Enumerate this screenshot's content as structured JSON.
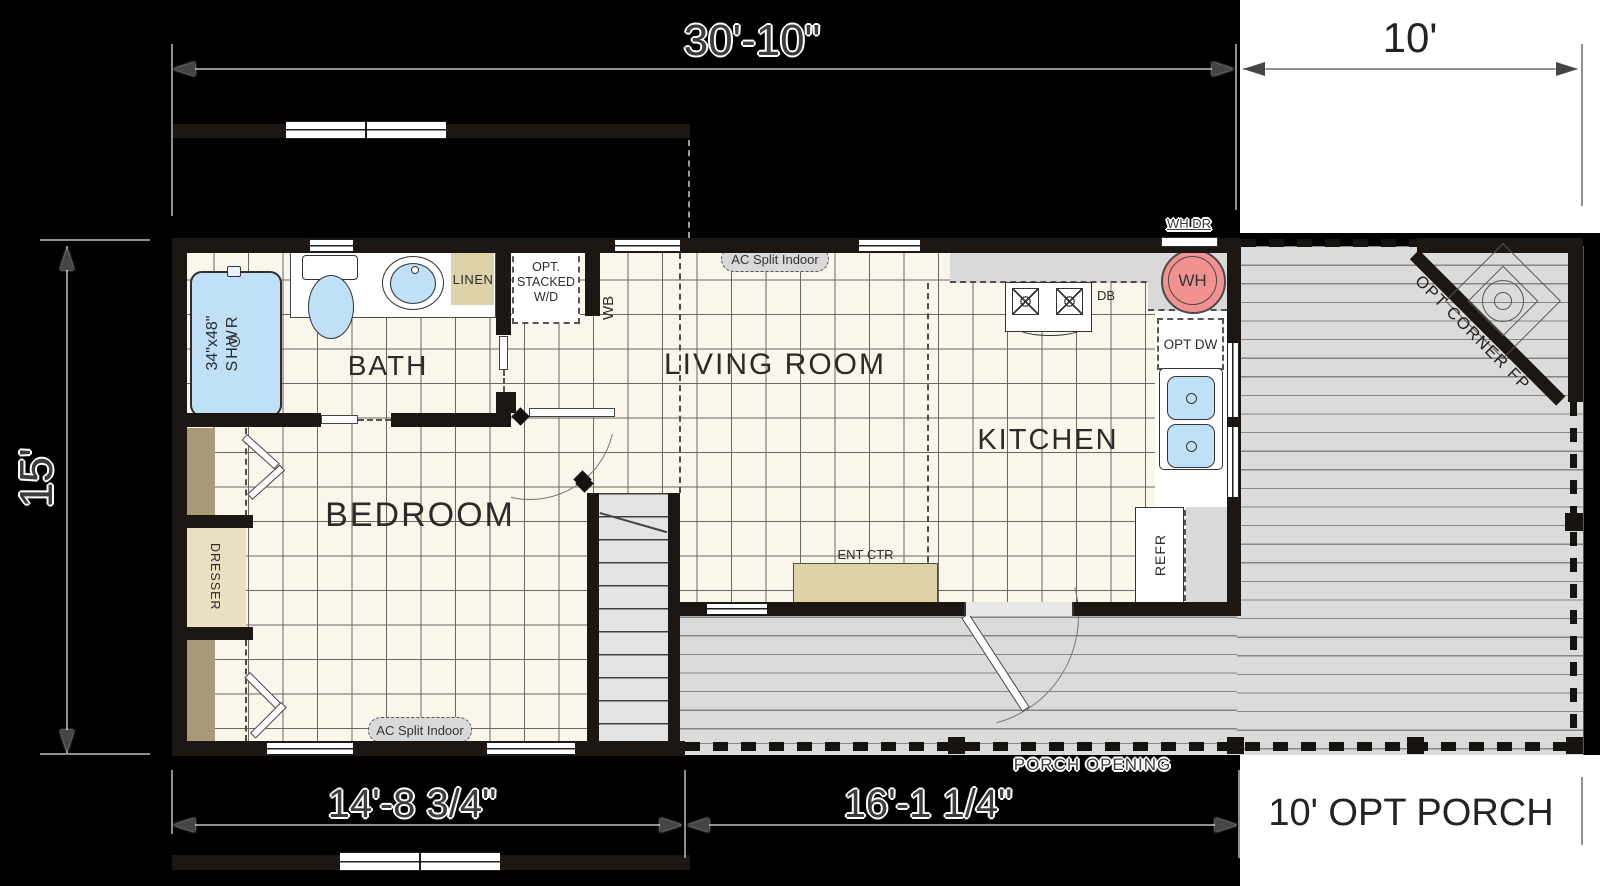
{
  "dimensions": {
    "width_main": "30'-10\"",
    "width_porch": "10'",
    "height_main": "15'",
    "width_module1": "14'-8 3/4\"",
    "width_module2": "16'-1 1/4\"",
    "porch_caption": "10' OPT PORCH"
  },
  "rooms": {
    "bath": "BATH",
    "bedroom": "BEDROOM",
    "living_room": "LIVING ROOM",
    "kitchen": "KITCHEN"
  },
  "labels": {
    "shower_size": "34\"x48\"",
    "shower": "SHWR",
    "linen": "LINEN",
    "wd_line1": "OPT.",
    "wd_line2": "STACKED",
    "wd_line3": "W/D",
    "wb": "WB",
    "ac_split": "AC Split Indoor",
    "wh": "WH",
    "wh_dr": "WH DR",
    "db": "DB",
    "opt_dw": "OPT DW",
    "refr": "REFR",
    "ent_ctr": "ENT CTR",
    "dresser": "DRESSER",
    "porch_opening": "PORCH OPENING",
    "opt_corner_fp": "OPT CORNER FP"
  }
}
